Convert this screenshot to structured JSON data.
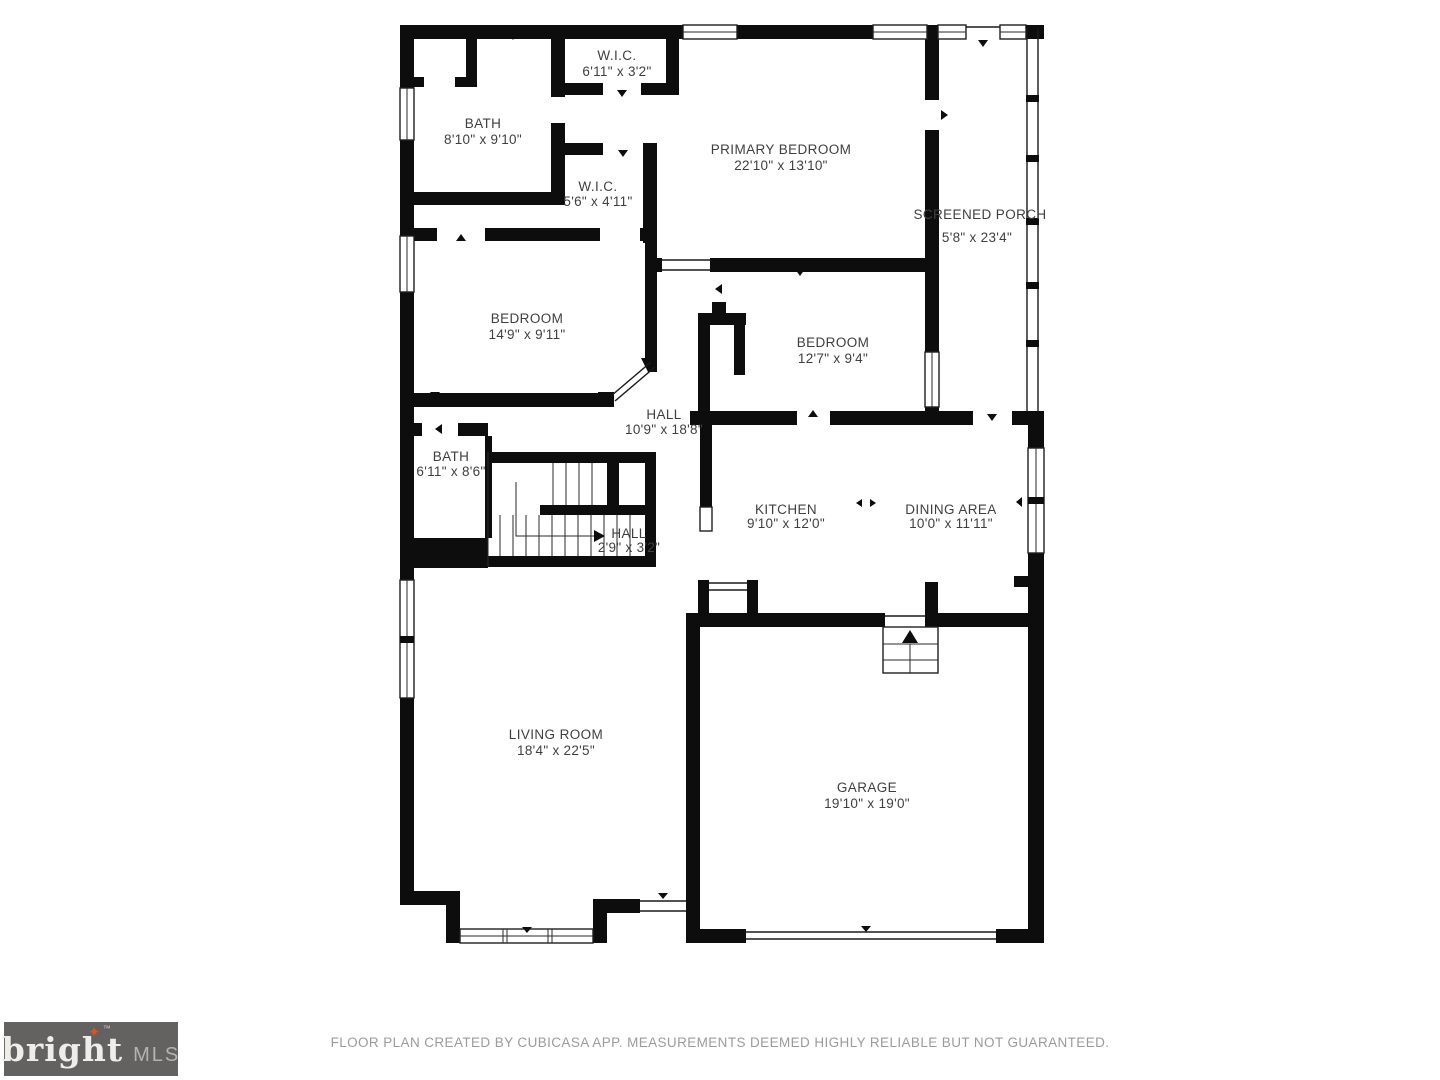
{
  "colors": {
    "wall": "#0d0d0d",
    "room_label": "#3f3f3f",
    "footer_text": "#9b9b9b",
    "logo_background": "#636260",
    "logo_text": "#efede9",
    "logo_star": "#e0521f",
    "logo_mls": "#b5b3af"
  },
  "rooms": [
    {
      "name": "W.I.C.",
      "dims": "6'11\" x 3'2\""
    },
    {
      "name": "BATH",
      "dims": "8'10\" x 9'10\""
    },
    {
      "name": "PRIMARY BEDROOM",
      "dims": "22'10\" x 13'10\""
    },
    {
      "name": "SCREENED PORCH",
      "dims": "5'8\" x 23'4\""
    },
    {
      "name": "W.I.C.",
      "dims": "5'6\" x 4'11\""
    },
    {
      "name": "BEDROOM",
      "dims": "14'9\" x 9'11\""
    },
    {
      "name": "BEDROOM",
      "dims": "12'7\" x 9'4\""
    },
    {
      "name": "HALL",
      "dims": "10'9\" x 18'8\""
    },
    {
      "name": "BATH",
      "dims": "6'11\" x 8'6\""
    },
    {
      "name": "KITCHEN",
      "dims": "9'10\" x 12'0\""
    },
    {
      "name": "DINING AREA",
      "dims": "10'0\" x 11'11\""
    },
    {
      "name": "HALL",
      "dims": "2'9\" x 3'2\""
    },
    {
      "name": "LIVING ROOM",
      "dims": "18'4\" x 22'5\""
    },
    {
      "name": "GARAGE",
      "dims": "19'10\" x 19'0\""
    }
  ],
  "footer": {
    "disclaimer": "FLOOR PLAN CREATED BY CUBICASA APP. MEASUREMENTS DEEMED HIGHLY RELIABLE BUT NOT GUARANTEED."
  },
  "logo": {
    "brand": "bright",
    "tm": "™",
    "suffix": "MLS"
  }
}
